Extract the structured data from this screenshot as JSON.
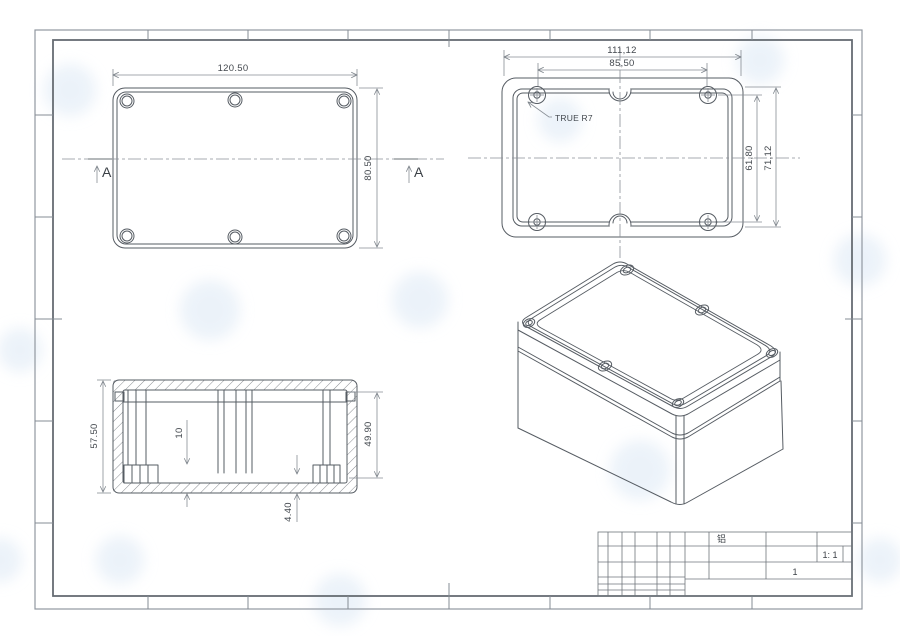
{
  "drawing": {
    "type": "engineering-drawing-enclosure",
    "views": {
      "top_view": {
        "dim_width": "120.50",
        "dim_height": "80.50",
        "section_arrow_left": "A",
        "section_arrow_right": "A"
      },
      "lid_view": {
        "dim_outer_width": "111,12",
        "dim_hole_spacing_h": "85,50",
        "dim_hole_spacing_v": "61,80",
        "dim_outer_height": "71,12",
        "radius_callout": "TRUE R7"
      },
      "section_view": {
        "dim_overall_height": "57.50",
        "dim_cavity_height": "49.90",
        "dim_boss_height": "10",
        "dim_base_thickness": "4.40"
      },
      "isometric_view": {
        "description": "enclosure-3d"
      }
    },
    "title_block": {
      "material": "铝",
      "scale": "1: 1",
      "sheet_number": "1"
    },
    "colors": {
      "geometry_line": "#565c63",
      "dimension_line": "#878d94",
      "text": "#43484e",
      "watermark": "#d9e6f4",
      "paper": "#ffffff"
    }
  }
}
